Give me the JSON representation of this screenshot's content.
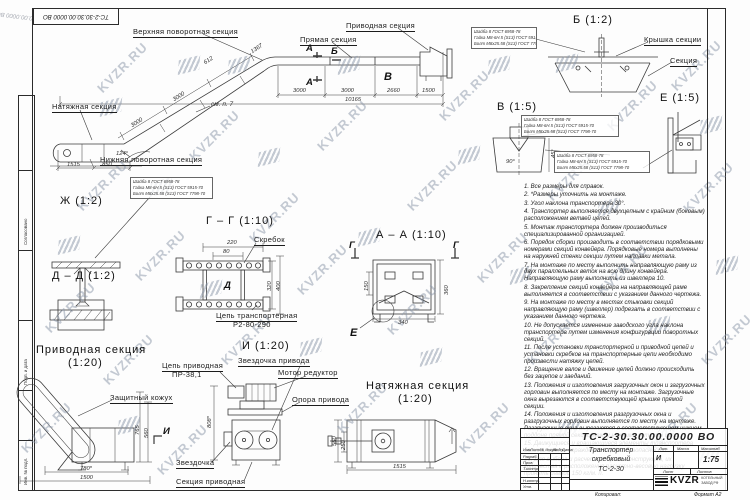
{
  "watermark": {
    "text": "KVZR.RU"
  },
  "corner_stamp": "ТС-2-30.30.00.0000 ВО",
  "overview": {
    "labels": {
      "upper_turn": "Верхняя поворотная секция",
      "straight": "Прямая секция",
      "drive": "Приводная секция",
      "tension": "Натяжная секция",
      "lower_turn": "Нижняя поворотная секция",
      "see_note": "см. п. 7"
    },
    "marks": {
      "a": "А",
      "b": "Б",
      "v": "В"
    },
    "dims": {
      "curve": "1367",
      "h0": "3000",
      "h1": "3000",
      "h2": "2660",
      "h3": "1500",
      "total": "10165",
      "i0": "612",
      "i1": "3000",
      "i2": "3000",
      "base0": "1515",
      "base1": "850",
      "angle": "124°"
    }
  },
  "callout_spec": {
    "l1": "Шайба 8 ГОСТ 6958-78",
    "l2": "Гайка М8-6Н.5 (S13) ГОСТ 5915-70",
    "l3": "Болт М8х25.58 (S13) ГОСТ 7798-70"
  },
  "views": {
    "zh": {
      "title": "Ж (1:2)"
    },
    "b": {
      "title": "Б (1:2)",
      "cover": "Крышка секции",
      "section": "Секция"
    },
    "v": {
      "title": "В (1:5)",
      "angle": "90°",
      "dim45": "45°"
    },
    "e": {
      "title": "Е (1:5)"
    },
    "gg": {
      "title": "Г – Г (1:10)",
      "scraper": "Скребок",
      "chain1": "Цепь транспортерная",
      "chain2": "Р2-80-290",
      "mark_d": "Д",
      "d220": "220",
      "d80": "80",
      "d320": "320",
      "d400": "400"
    },
    "aa": {
      "title": "А – А (1:10)",
      "mark_g": "Г",
      "mark_e": "Е",
      "d150": "150",
      "d360": "360",
      "d340": "340"
    },
    "dd": {
      "title": "Д – Д (1:2)"
    },
    "drive_sec": {
      "title1": "Приводная секция",
      "title2": "(1:20)",
      "guard": "Защитный кожух",
      "d780": "780*",
      "d1500": "1500",
      "d560": "560",
      "d765": "765",
      "mark_i": "И"
    },
    "i": {
      "title": "И (1:20)",
      "chain1": "Цепь приводная",
      "chain2": "ПР-38,1",
      "sprocket_drive": "Звездочка привода",
      "motor": "Мотор редуктор",
      "support": "Опора привода",
      "sprocket": "Звездочка",
      "section": "Секция приводная",
      "d808": "808*"
    },
    "tension_sec": {
      "title1": "Натяжная секция",
      "title2": "(1:20)",
      "d1515": "1515",
      "d560": "560",
      "d250": "250"
    }
  },
  "notes": [
    "1. Все размеры для справок.",
    "2. *Размеры уточнить на монтаже.",
    "3. Угол наклона транспортера 30°.",
    "4. Транспортер выполняется двухцепным с крайним (боковым) расположением ветвей цепей.",
    "5. Монтаж транспортера должен производиться специализированной организацией.",
    "6. Порядок сборки производить в соответствии порядковыми номерами секций конвейера. Порядковые номера выполнены на наружней стенки секции путем наплавки метала.",
    "7. На монтаже по месту выполнить направляющую раму из двух параллельных веток на всю длину конвейера. Направляющую раму выполнить из швеллера 10.",
    "8. Закрепление секций конвейера на направляющей раме выполняется в соответствии с указанием данного чертежа.",
    "9. На монтаже по месту в местах стыковки секций направляющую раму (швеллер) подрезать в соответствии с указанием данного чертежа.",
    "10. Не допускается изменение заводского угла наклона транспортера путем изменения конфигурации поворотных секций.",
    "11. После установки транспортерной и приводной цепей и установки скребков на транспортерные цепи необходимо произвести натяжку цепей.",
    "12. Вращение валов и движение цепей должно происходить без зацепов и заеданий.",
    "13. Положения и изготовления загрузочных окон и загрузочных горловин выполняется по месту на монтаже. Загрузочные окна вырезаются в соответствующей крышке прямой секции.",
    "14. Положения и изготовления разгрузочных окна и разгрузочных горловин выполняется по месту на монтаже. Разгрузочные окна вырезаются в соответствующем нижнем поддоне прямой секции между нижними ветвями цепи.",
    "15. Движущиеся и вращающиеся элементы транспортера должны иметь ограждения в целях безопасности.",
    "16. Для выбора и расчета опорных конструкций, их количества и расположения расчетно-весовую нагрузку принять равной 150 кг/м. п."
  ],
  "title_block": {
    "doc_number": "ТС-2-30.30.00.0000  ВО",
    "name1": "Транспортер",
    "name2": "скребковый",
    "name3": "ТС-2-30",
    "lit_header": "Лит.",
    "mass_header": "Масса",
    "scale_header": "Масштаб",
    "lit": "И",
    "scale": "1:75",
    "sheet_header": "Лист",
    "sheets_header": "Листов",
    "col_izm": "Изм.",
    "col_list": "Лист",
    "col_doc": "№ докум.",
    "col_sign": "Подп.",
    "col_date": "Дата",
    "row_razrab": "Разраб.",
    "row_prov": "Пров.",
    "row_tkontr": "Т.контр.",
    "row_nkontr": "Н.контр.",
    "row_utv": "Утв.",
    "logo_text": "KVZR",
    "logo_sub1": "КОТЕЛЬНЫЙ",
    "logo_sub2": "ЗАВОД РФ",
    "copied_label": "Копировал:",
    "format_label": "Формат А2"
  },
  "side_strip": {
    "s1": "Согласовано",
    "s2": "Подп. и дата",
    "s3": "Инв. № подл."
  }
}
